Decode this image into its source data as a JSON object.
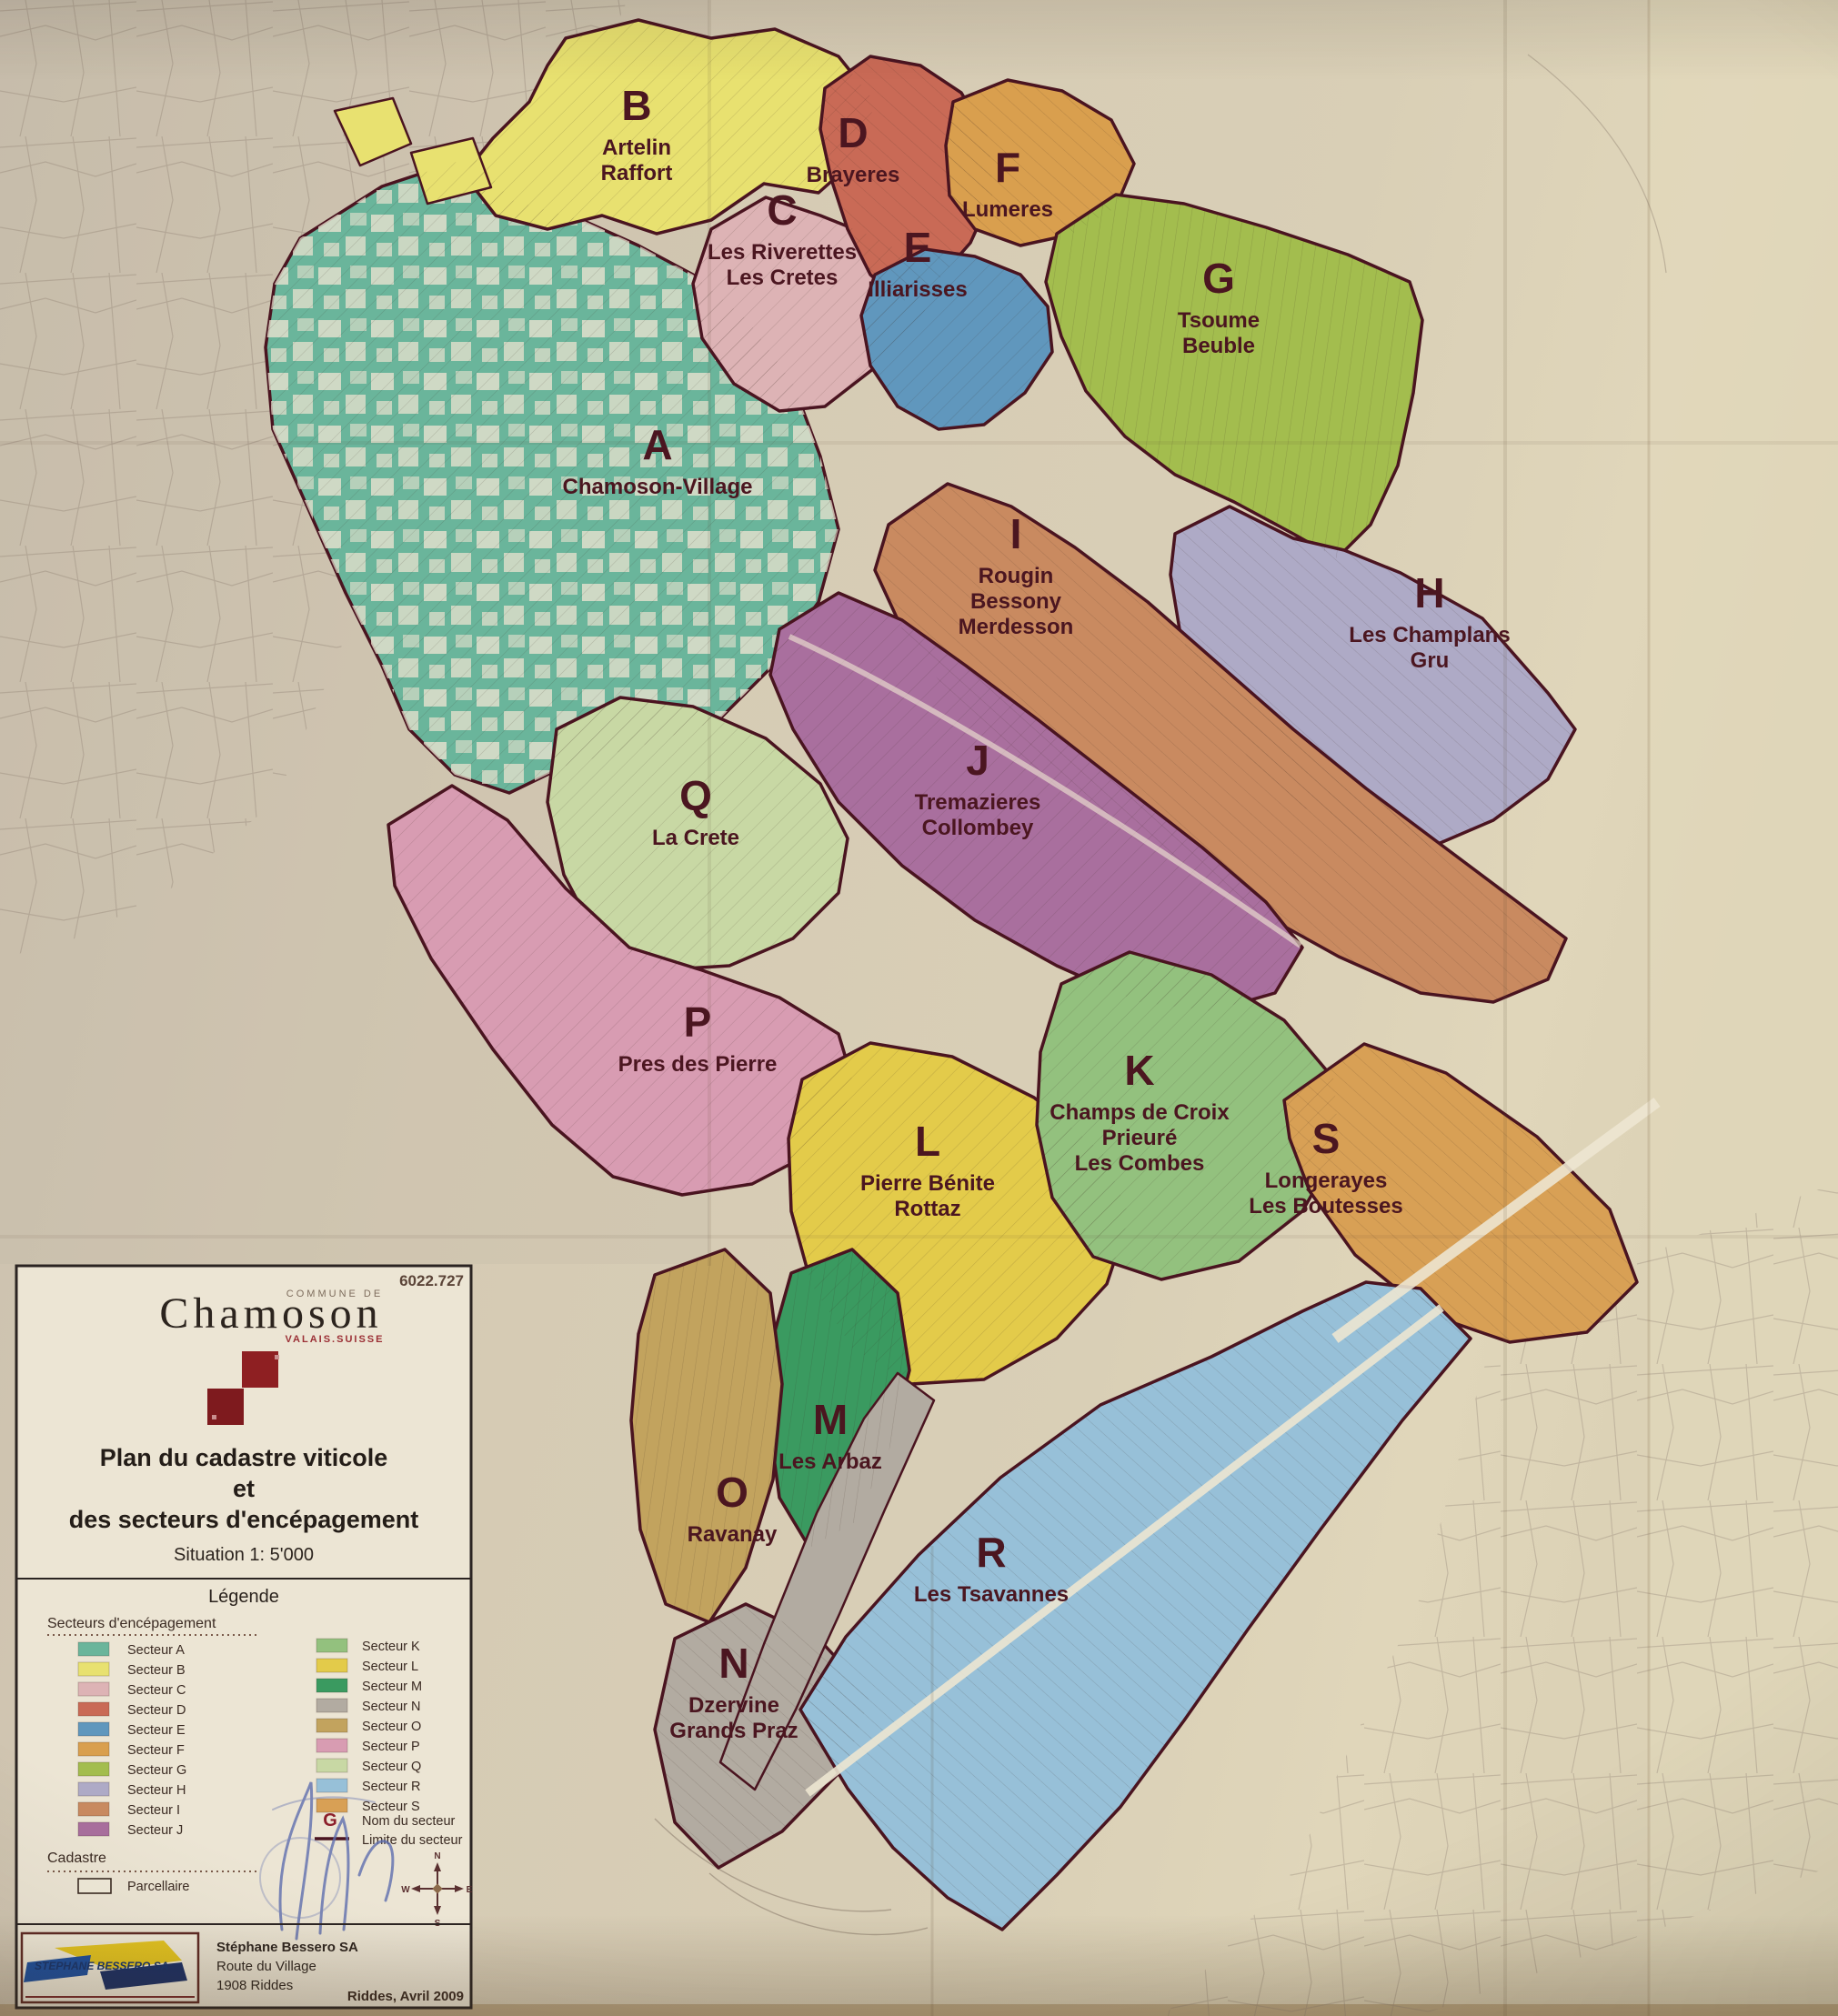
{
  "sheet_number": "6022.727",
  "header": {
    "commune_label": "COMMUNE DE",
    "commune_name": "Chamoson",
    "region_label": "VALAIS.SUISSE"
  },
  "title": {
    "line1": "Plan du cadastre viticole",
    "line2": "et",
    "line3": "des secteurs d'encépagement",
    "situation": "Situation 1: 5'000"
  },
  "legend": {
    "heading": "Légende",
    "sectors_heading": "Secteurs d'encépagement",
    "entry_prefix": "Secteur",
    "name_symbol": "G",
    "name_label": "Nom du secteur",
    "limit_label": "Limite du secteur",
    "cadastre_heading": "Cadastre",
    "parcel_label": "Parcellaire"
  },
  "compass": {
    "n": "N",
    "e": "E",
    "s": "S",
    "w": "W"
  },
  "footer": {
    "logo_text": "STEPHANE BESSERO SA",
    "firm_name": "Stéphane Bessero SA",
    "street": "Route du Village",
    "city": "1908 Riddes",
    "date_note": "Riddes, Avril 2009"
  },
  "map": {
    "boundary_color": "#4a1420",
    "sectors": [
      {
        "letter": "A",
        "name_lines": [
          "Chamoson-Village"
        ],
        "color": "#6ab59b"
      },
      {
        "letter": "B",
        "name_lines": [
          "Artelin",
          "Raffort"
        ],
        "color": "#e8e170"
      },
      {
        "letter": "C",
        "name_lines": [
          "Les Riverettes",
          "Les Cretes"
        ],
        "color": "#ddb3b5"
      },
      {
        "letter": "D",
        "name_lines": [
          "Brayeres"
        ],
        "color": "#c96a56"
      },
      {
        "letter": "E",
        "name_lines": [
          "Illiarisses"
        ],
        "color": "#6097bd"
      },
      {
        "letter": "F",
        "name_lines": [
          "Lumeres"
        ],
        "color": "#d99f4e"
      },
      {
        "letter": "G",
        "name_lines": [
          "Tsoume",
          "Beuble"
        ],
        "color": "#a3bd4e"
      },
      {
        "letter": "H",
        "name_lines": [
          "Les Champlans",
          "Gru"
        ],
        "color": "#aeaac6"
      },
      {
        "letter": "I",
        "name_lines": [
          "Rougin",
          "Bessony",
          "Merdesson"
        ],
        "color": "#c98a60"
      },
      {
        "letter": "J",
        "name_lines": [
          "Tremazieres",
          "Collombey"
        ],
        "color": "#a96f9e"
      },
      {
        "letter": "K",
        "name_lines": [
          "Champs de Croix",
          "Prieuré",
          "Les Combes"
        ],
        "color": "#93c17e"
      },
      {
        "letter": "L",
        "name_lines": [
          "Pierre Bénite",
          "Rottaz"
        ],
        "color": "#e3cb4a"
      },
      {
        "letter": "M",
        "name_lines": [
          "Les Arbaz"
        ],
        "color": "#3a9a60"
      },
      {
        "letter": "N",
        "name_lines": [
          "Dzervine",
          "Grands Praz"
        ],
        "color": "#b2aba1"
      },
      {
        "letter": "O",
        "name_lines": [
          "Ravanay"
        ],
        "color": "#c2a35e"
      },
      {
        "letter": "P",
        "name_lines": [
          "Pres des Pierre"
        ],
        "color": "#d89cb2"
      },
      {
        "letter": "Q",
        "name_lines": [
          "La Crete"
        ],
        "color": "#c8d8a4"
      },
      {
        "letter": "R",
        "name_lines": [
          "Les Tsavannes"
        ],
        "color": "#97c0d8"
      },
      {
        "letter": "S",
        "name_lines": [
          "Longerayes",
          "Les Boutesses"
        ],
        "color": "#d8a055"
      }
    ]
  }
}
